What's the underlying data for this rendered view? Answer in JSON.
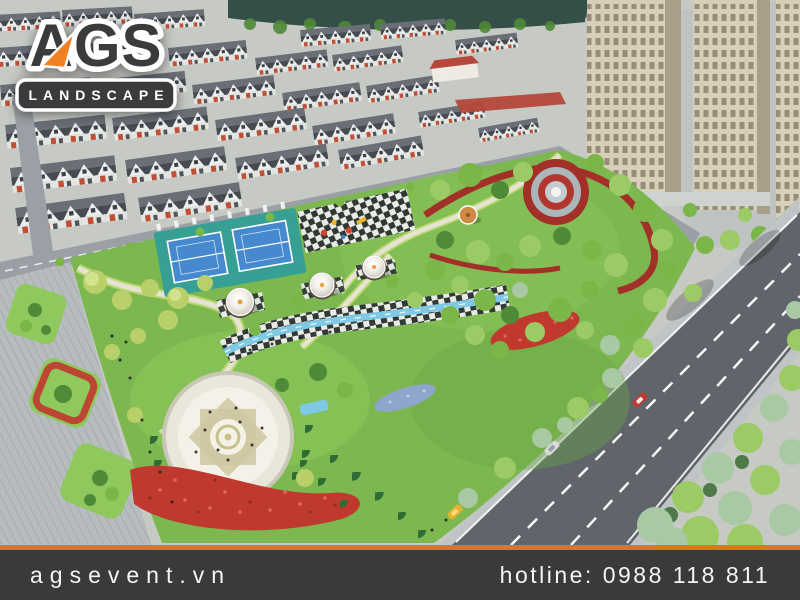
{
  "logo": {
    "name": "AGS",
    "tagline": "LANDSCAPE"
  },
  "footer": {
    "website": "agsevent.vn",
    "hotline_label": "hotline:",
    "hotline_number": "0988 118 811"
  },
  "scene": {
    "description": "Aerial 3D render of a residential park masterplan: townhouse rows and lake at top, high-rise towers top right, central park with tennis courts, playground, round pavilions, stream walk, sun-pattern plaza, flower beds, red ribbon garden with fountain, main road with cars, pedestrian boulevard with palm islands",
    "features": [
      "townhouse-rows",
      "lake",
      "high-rise-towers",
      "tennis-courts",
      "playground",
      "round-pavilions",
      "stream-walk",
      "sun-plaza",
      "flower-beds",
      "red-ribbon-garden",
      "fountain",
      "gazebo",
      "main-road",
      "pedestrian-boulevard",
      "street-cars"
    ]
  },
  "theme": {
    "footer_bg": "#3a3a3c",
    "footer_accent": "#e8721c",
    "footer_text": "#f4f4f4",
    "logo_dark": "#3b3b3d",
    "logo_orange": "#f08021",
    "logo_white": "#ffffff",
    "ground": "#c6c9c4",
    "water": "#334f48",
    "road": "#60656b",
    "road_light": "#9aa0a5",
    "pavement": "#c0c4c6",
    "grass": "#7cb84f",
    "grass_light": "#8fc95e",
    "grass_dark": "#69a844",
    "roof_dark": "#464b52",
    "roof_light": "#6a6f77",
    "roof_red": "#b5483a",
    "facade": "#edefee",
    "accent_red": "#c14f35",
    "tower": "#d8cfba",
    "tower_shade": "#a89f8a",
    "tower_win": "#8d8671",
    "court_apron": "#35a093",
    "court_blue": "#4689cf",
    "stream": "#7fc9e4",
    "path": "#e6e3d4",
    "path_edge": "#b9d96e",
    "flower_red": "#c0392e",
    "flower_blue": "#8ea6cc",
    "ribbon_red": "#a33028",
    "ring_gray": "#aab6ba",
    "tree_yellow": "#b8cf6a",
    "tree_light": "#9ccb66",
    "tree_mid": "#7ab648",
    "tree_dark": "#4e8a38",
    "tree_conifer": "#2f6b35",
    "tree_sage": "#a9c9a4",
    "gazebo": "#cf8a44",
    "car_red": "#c03a30",
    "car_silver": "#d8dadc",
    "car_yellow": "#e8b42a",
    "people": "#1c1c1c"
  }
}
